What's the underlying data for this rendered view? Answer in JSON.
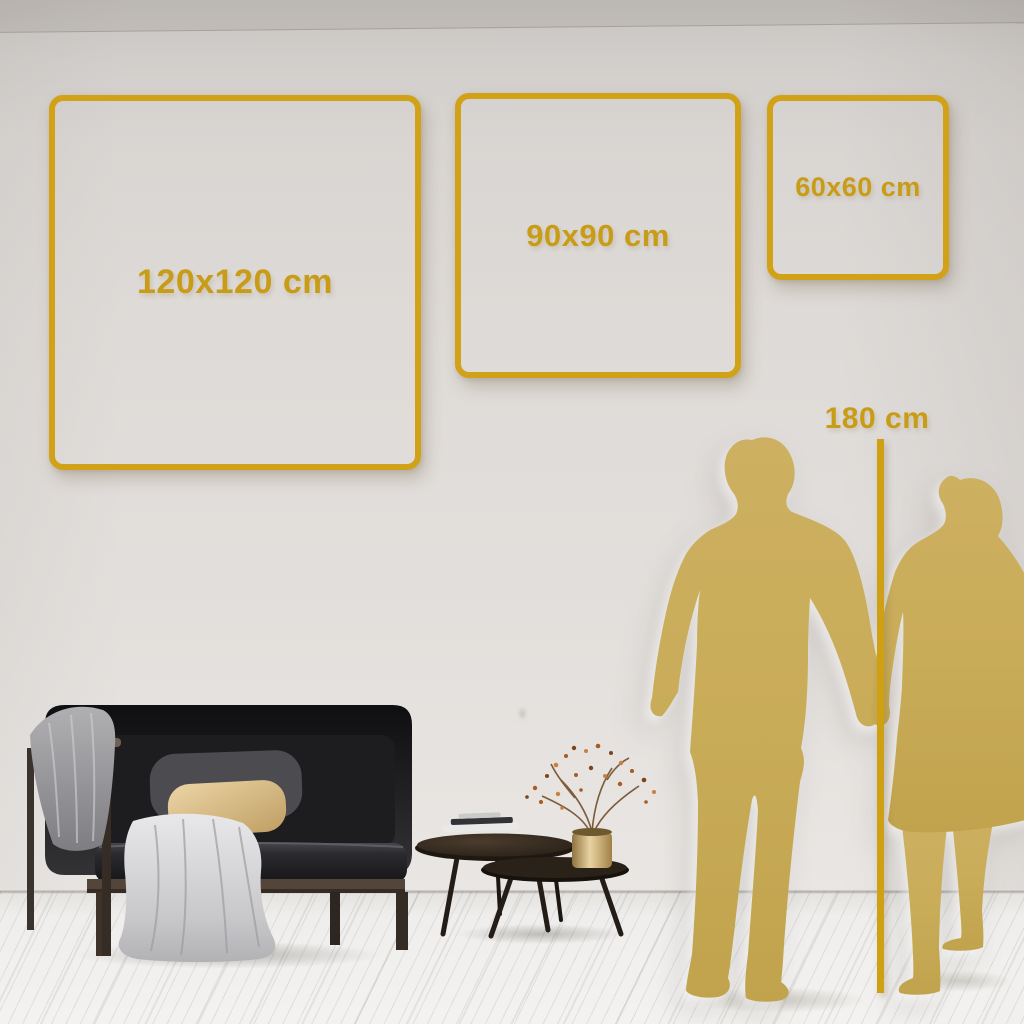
{
  "title": "Wall art size comparison guide",
  "size_frames": [
    {
      "label": "120x120 cm",
      "width_cm": 120,
      "height_cm": 120
    },
    {
      "label": "90x90 cm",
      "width_cm": 90,
      "height_cm": 90
    },
    {
      "label": "60x60 cm",
      "width_cm": 60,
      "height_cm": 60
    }
  ],
  "height_marker": {
    "label": "180 cm",
    "height_cm": 180
  },
  "colors": {
    "frame_gold": "#d1a117",
    "label_gold": "#c89c16",
    "ruler_gold": "#d0a014",
    "silhouette_gold": "#c9ac58",
    "wall": "#dedad7",
    "floor": "#f3f2f0"
  },
  "decor": {
    "silhouettes": [
      {
        "name": "man"
      },
      {
        "name": "woman"
      }
    ],
    "furniture": [
      {
        "name": "sofa"
      },
      {
        "name": "gray blanket"
      },
      {
        "name": "white throw"
      },
      {
        "name": "beige pillow"
      },
      {
        "name": "gray pillow"
      },
      {
        "name": "nesting coffee tables"
      },
      {
        "name": "books"
      },
      {
        "name": "gold vase with dried plant"
      }
    ]
  }
}
